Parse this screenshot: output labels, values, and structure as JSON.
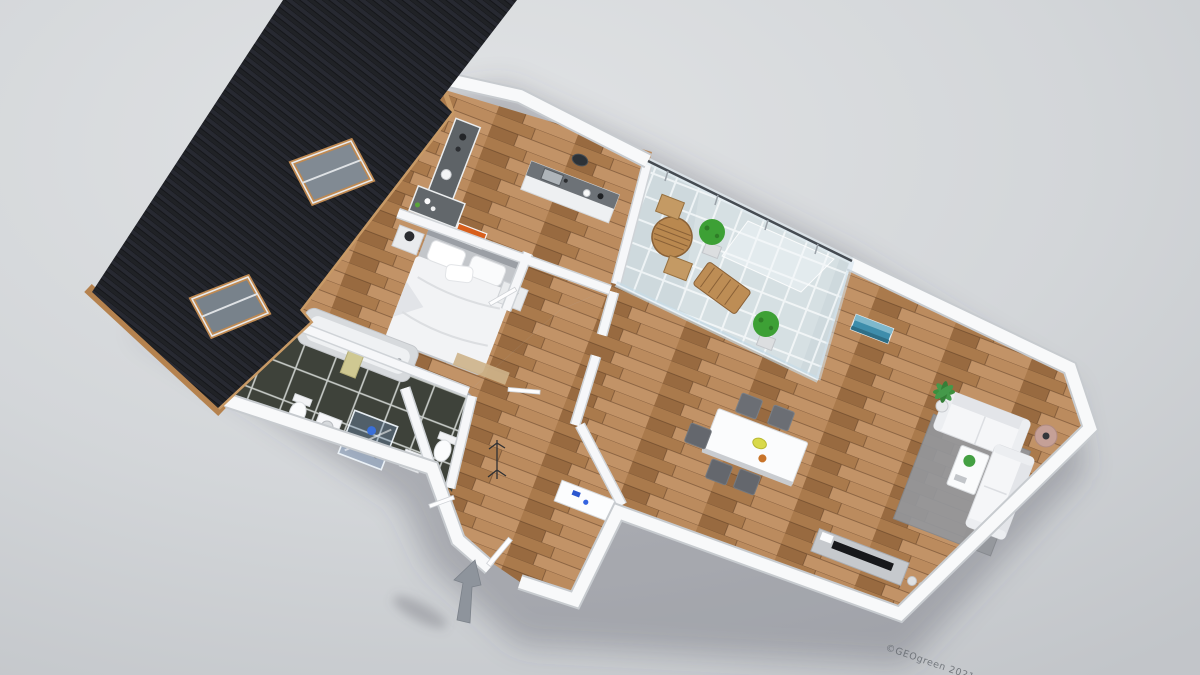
{
  "scene": {
    "type": "3d-floor-plan-render",
    "view": "aerial-dollhouse-perspective",
    "background_color": "#cdd0d4",
    "watermark": {
      "text": "©GEOgreen 2021",
      "color": "#60656b"
    },
    "entrance": {
      "indicator": "arrow-icon",
      "color": "#8e949c"
    },
    "roof": {
      "style": "dark-shingle",
      "color": "#202226",
      "trim_color": "#b5824e",
      "skylights": 2
    },
    "rooms": [
      {
        "name": "bedroom",
        "floor": "wood",
        "items": [
          "double-bed",
          "nightstand-left",
          "nightstand-right",
          "table-lamps",
          "orange-wall-art"
        ]
      },
      {
        "name": "kitchen",
        "floor": "wood",
        "items": [
          "l-shaped-counter",
          "sink-counter",
          "wall-clock",
          "canisters",
          "kettle"
        ]
      },
      {
        "name": "bathroom",
        "floor": "dark-tile",
        "items": [
          "bathtub",
          "towel",
          "toilet",
          "washbasin",
          "glass-shower",
          "blue-towel"
        ]
      },
      {
        "name": "wc",
        "floor": "dark-tile",
        "items": [
          "toilet",
          "washbasin"
        ]
      },
      {
        "name": "hallway",
        "floor": "wood",
        "items": [
          "coat-rack",
          "shoe-cabinet",
          "entry-door"
        ]
      },
      {
        "name": "balcony",
        "floor": "light-tile",
        "items": [
          "round-table",
          "chair",
          "chair",
          "sun-lounger",
          "boxwood-plant",
          "boxwood-plant",
          "glass-canopy",
          "glass-railing"
        ]
      },
      {
        "name": "living-dining-room",
        "floor": "wood",
        "items": [
          "dining-table",
          "dining-chairs-x5",
          "yellow-bowl",
          "area-rug",
          "sofa-two-seat",
          "sofa-two-seat",
          "coffee-table",
          "floor-lamp",
          "palm-plant",
          "tv-sideboard",
          "tv",
          "vases",
          "teal-wall-art"
        ]
      }
    ]
  },
  "palette": {
    "wall": "#f8f9fa",
    "wall_shadow": "#c7cbcf",
    "wood_floor": "#b1825a",
    "bathroom_tile": "#3e423a",
    "balcony_tile": "#ced9dd",
    "rug": "#94979c",
    "sofa": "#f5f6f8",
    "dining_chair": "#64676d",
    "accent_orange": "#d85f1c",
    "accent_teal": "#3e8dab",
    "plant_green": "#3da035",
    "roof": "#202226",
    "wood_trim": "#b5824e",
    "arrow": "#8e949c"
  }
}
